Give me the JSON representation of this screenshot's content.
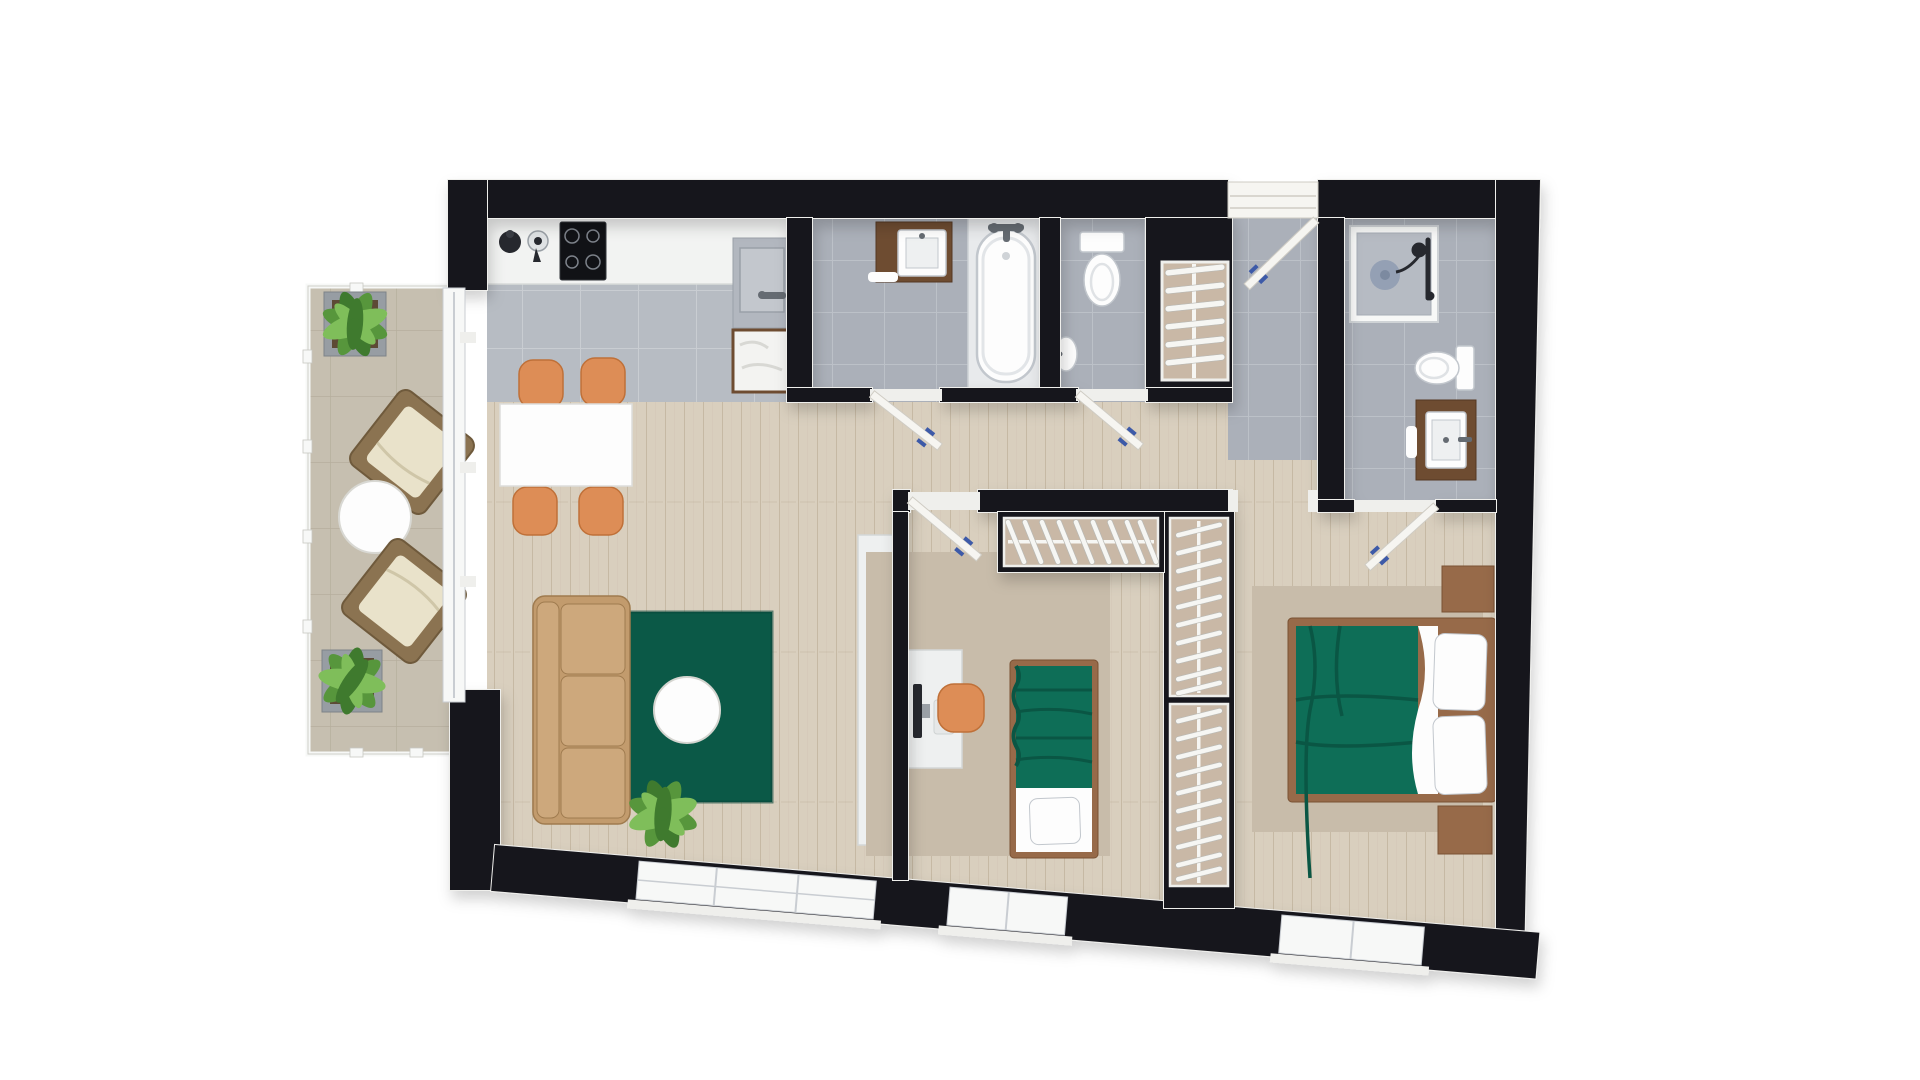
{
  "meta": {
    "description": "Top-down 3D rendered floor plan of a two-bedroom apartment with balcony",
    "view": "bird's-eye architectural render, slight clockwise tilt",
    "background": "#ffffff"
  },
  "palette": {
    "wall": "#17161d",
    "wallTrim": "#efefec",
    "wood": "#d9cfbe",
    "woodLine": "#c2b49e",
    "kitchenTile": "#b7bcc3",
    "kitchenTileLine": "#c9cdd2",
    "bathTile": "#abb0b9",
    "bathTileLine": "#bcc1c8",
    "balconyTile": "#c6bfb0",
    "balconyTileLine": "#b2aa99",
    "rugGreen": "#0b5947",
    "fabricGreen": "#0e6e57",
    "rugBeige": "#c8bcaa",
    "sofaTan": "#c29b6d",
    "sofaTanLight": "#cda87c",
    "sofaTanDark": "#9f7b4f",
    "chairOrange": "#dd8d56",
    "chairOrangeDark": "#bf7038",
    "bedBrown": "#976a49",
    "bedBrownDark": "#7a5234",
    "vanityBrown": "#6e4c31",
    "vanityBrownDark": "#543823",
    "wardrobeBack": "#c9b8a6",
    "porcelain": "#fdfdfd",
    "fixtureLine": "#c2c7cd",
    "glassWhite": "#f7f8f7",
    "glassLine": "#c9cdd2",
    "doorWhite": "#f6f5f1",
    "doorEdge": "#cfccc4",
    "hangerWhite": "#f6f6f3",
    "hangerEdge": "#b9b9b4",
    "handleBlue": "#3d5aa8",
    "steel": "#656b72",
    "dark": "#26282e",
    "trayGray": "#b6bbc3",
    "drainGray": "#94a0b4",
    "plantGreen1": "#57963c",
    "plantGreen2": "#7fbe5a",
    "plantGreen3": "#3f7a2e",
    "planterGray": "#979da3",
    "wicker": "#8b7351",
    "wickerDark": "#6f5a3c",
    "cushionCream": "#e9e2ca",
    "tvWhite": "#eef0f0",
    "counterWhite": "#f2f3f2"
  },
  "floor_plan": {
    "rooms": [
      {
        "name": "balcony",
        "floor": "beige tile",
        "furniture": [
          "potted-plant",
          "lounge-chair",
          "round-side-table",
          "lounge-chair",
          "potted-plant"
        ],
        "boundary": "glass balustrade"
      },
      {
        "name": "kitchen",
        "floor": "gray tile",
        "furniture": [
          "white-countertop",
          "kettle",
          "moka-pot",
          "induction-hob-4-burners",
          "sink-counter-with-faucet",
          "washing-machine"
        ]
      },
      {
        "name": "dining-area",
        "floor": "wood",
        "furniture": [
          "white-dining-table",
          "orange-chair",
          "orange-chair",
          "orange-chair",
          "orange-chair"
        ]
      },
      {
        "name": "living-room",
        "floor": "wood",
        "furniture": [
          "tan-three-seat-sofa",
          "green-rug",
          "white-round-coffee-table",
          "potted-plant",
          "tv-sideboard",
          "tv"
        ]
      },
      {
        "name": "bathroom",
        "floor": "gray tile",
        "furniture": [
          "brown-vanity-with-sink",
          "bathtub-with-faucet"
        ]
      },
      {
        "name": "wc",
        "floor": "gray tile",
        "furniture": [
          "toilet",
          "corner-hand-basin"
        ]
      },
      {
        "name": "hall-closet",
        "furniture": [
          "shelving-unit-6-shelves"
        ]
      },
      {
        "name": "entry-hall",
        "floor": "gray tile",
        "furniture": [
          "entrance-door"
        ]
      },
      {
        "name": "ensuite-shower-room",
        "floor": "gray tile",
        "furniture": [
          "shower-with-drain-and-handset",
          "toilet",
          "brown-vanity-with-sink"
        ]
      },
      {
        "name": "bedroom-small",
        "floor": "wood",
        "furniture": [
          "open-wardrobe-with-hangers",
          "desk",
          "monitor",
          "orange-stool",
          "single-bed-green-cover",
          "beige-rug"
        ]
      },
      {
        "name": "bedroom-master",
        "floor": "wood",
        "furniture": [
          "double-wardrobe-column-with-hangers",
          "double-bed-green-cover",
          "pillow",
          "pillow",
          "nightstand",
          "nightstand",
          "beige-rug"
        ]
      }
    ],
    "doors": [
      {
        "name": "entrance-door",
        "state": "open"
      },
      {
        "name": "bathroom-door",
        "state": "open"
      },
      {
        "name": "wc-door",
        "state": "open"
      },
      {
        "name": "bedroom-small-door",
        "state": "open"
      },
      {
        "name": "ensuite-door",
        "state": "open"
      },
      {
        "name": "balcony-sliding-door",
        "state": "closed"
      }
    ],
    "windows": [
      "living-room-window",
      "bedroom-small-window",
      "bedroom-master-window"
    ],
    "counts": {
      "hangers_wardrobe_small": 9,
      "hangers_wardrobe_master_upper": 10,
      "hangers_wardrobe_master_lower": 10,
      "closet_shelves": 6,
      "hob_burners": 4,
      "sofa_seats": 3
    }
  }
}
